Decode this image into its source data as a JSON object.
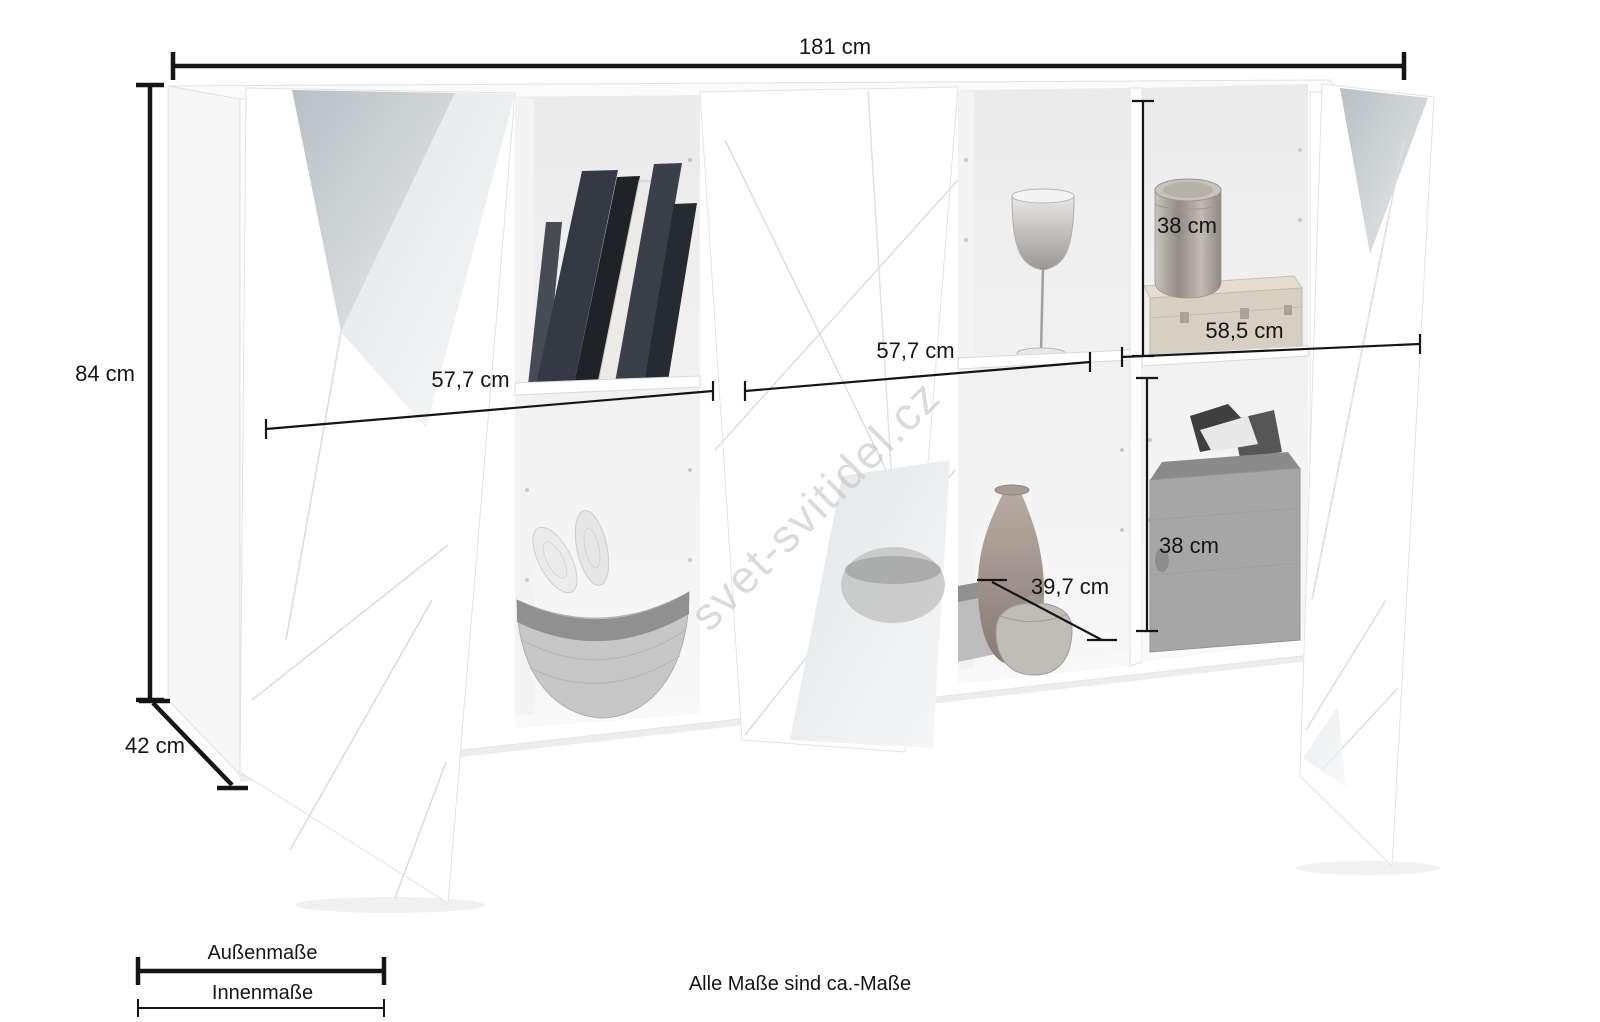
{
  "watermark": {
    "text": "svet-svitidel.cz"
  },
  "footnote": {
    "text": "Alle Maße sind ca.-Maße"
  },
  "legend": {
    "outer": "Außenmaße",
    "inner": "Innenmaße"
  },
  "dimensions": {
    "total_width": "181 cm",
    "total_height": "84 cm",
    "total_depth": "42 cm",
    "inner_width_left": "57,7 cm",
    "inner_width_middle": "57,7 cm",
    "inner_width_right": "58,5 cm",
    "inner_height_upper": "38 cm",
    "inner_height_lower": "38 cm",
    "inner_depth": "39,7 cm"
  }
}
